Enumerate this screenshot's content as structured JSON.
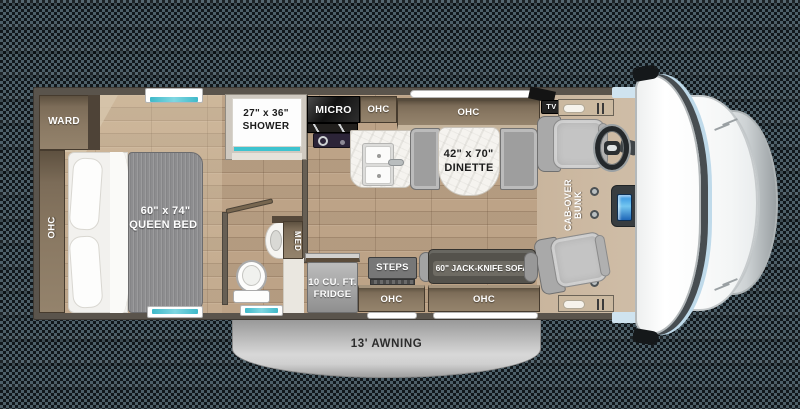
{
  "title": "Class C motorhome floor plan",
  "labels": {
    "ward": "WARD",
    "ohc_bedroom": "OHC",
    "bed_size": "60\" x 74\"",
    "bed_name": "QUEEN BED",
    "shower_size": "27\" x 36\"",
    "shower_name": "SHOWER",
    "micro": "MICRO",
    "ohc_kitchen": "OHC",
    "ohc_dinette": "OHC",
    "dinette_size": "42\" x 70\"",
    "dinette_name": "DINETTE",
    "tv": "TV",
    "cab_over_line1": "CAB-OVER",
    "cab_over_line2": "BUNK",
    "med": "MED",
    "fridge_line1": "10 CU. FT.",
    "fridge_line2": "FRIDGE",
    "steps": "STEPS",
    "sofa": "60\" JACK-KNIFE SOFA",
    "ohc_entry": "OHC",
    "ohc_sofa": "OHC",
    "awning": "13' AWNING"
  },
  "colors": {
    "wall": "#5a544c",
    "wood_floor": "#bda387",
    "cab_floor": "#cdbaa3",
    "cabinet_brown": "#8a7963",
    "accent_teal": "#3ec3cf",
    "awning_gray": "#c2c2c2",
    "sofa_gray": "#54524c",
    "bed_gray": "#8d8d8f",
    "seat_gray": "#c4c4c4"
  }
}
